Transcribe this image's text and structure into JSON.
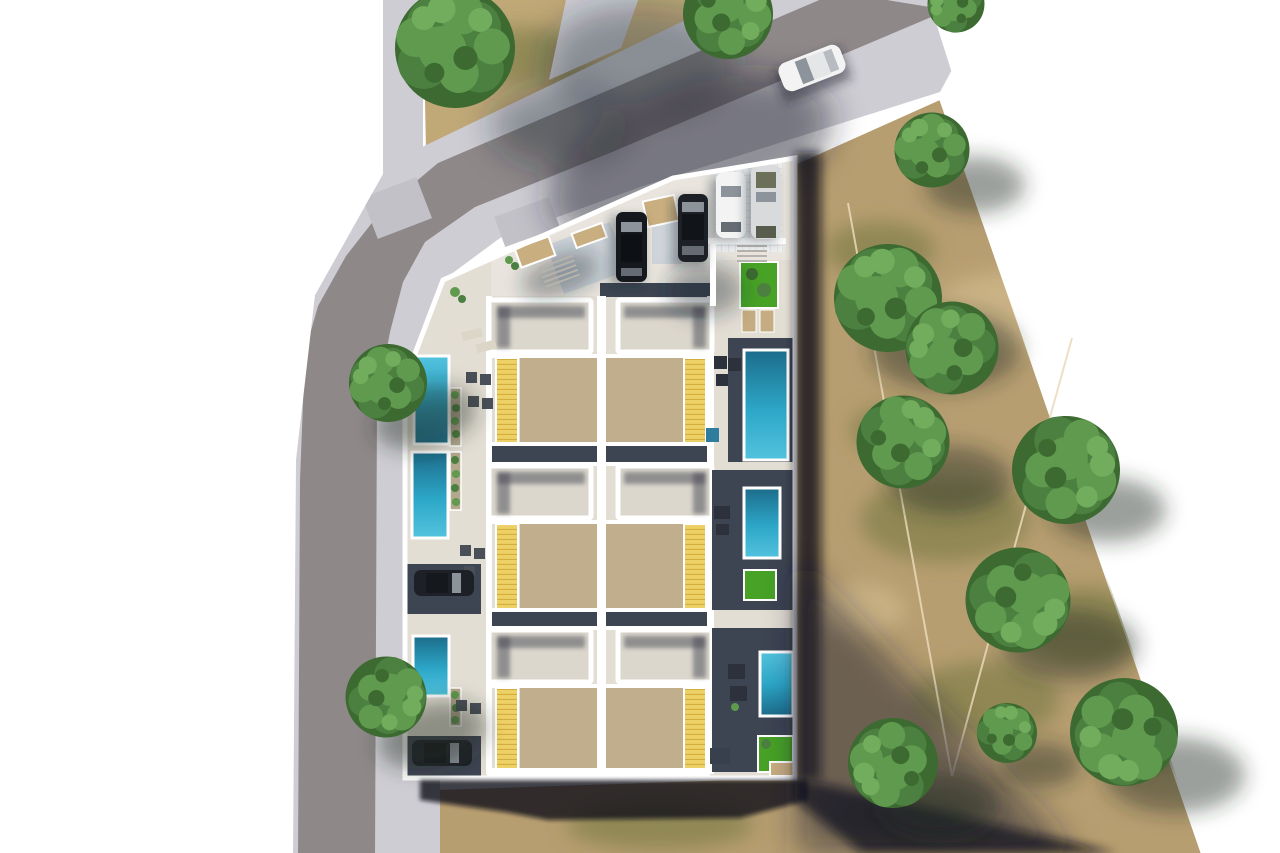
{
  "scene": {
    "type": "aerial-architectural-render",
    "description": "Top-down 3D rendering of a residential complex of six attached villas with flat roofs, sand courtyards, yellow louvered pergolas, private pools and a parking court; bordered by a diagonal street at top, a vertical street at left, and a dry field with trees at right",
    "units_total": 6,
    "rows": 3,
    "units_per_row": 2
  },
  "complex": {
    "pools": {
      "count": 6,
      "left_column": 3,
      "right_column": 3
    },
    "lawn_patches": 3,
    "louver_pergolas": 6,
    "roof_slabs": 6,
    "plaza_parked_cars": [
      "dark",
      "dark",
      "white",
      "silver"
    ],
    "driveway_cars": 2,
    "street_cars": 1,
    "planter_boxes": 3,
    "stair_flights": 2
  },
  "environment": {
    "roads": [
      "diagonal street top",
      "vertical street left"
    ],
    "sidewalks": true,
    "top_trees": 3,
    "street_trees": 2,
    "field_trees": 9,
    "survey_marker": "thin V-shaped boundary line in field"
  },
  "colors": {
    "white": "#ffffff",
    "field": "#b79e71",
    "grass": "#c0a877",
    "mottleGreen": "rgba(106,112,58,0.5)",
    "mottleTan": "rgba(216,194,150,0.55)",
    "pave": "#cecdd3",
    "road": "#8e8889",
    "pad": "#c2c1c8",
    "vline": "#ead9b8",
    "plaza": "#e9e5de",
    "patio": "#e3ded4",
    "deck": "#3d4452",
    "court": "#c0ae8d",
    "roof": "#dcd7cd",
    "roofShade": "rgba(68,70,82,0.5)",
    "wall": "#ffffff",
    "louver": "#eed166",
    "louverLine": "#d2ae3f",
    "poolBright": "#53c3de",
    "poolMid": "#2da7c8",
    "poolDeep": "#1c6c8a",
    "lawn": "#47a226",
    "planter": "#c9ae80",
    "planterDark": "#b3a78c",
    "treeA": "#3c6a31",
    "treeB": "#4c8040",
    "treeC": "#5f9a4e",
    "treeD": "#71ad5c",
    "chair": "#4a5058",
    "furn": "#2c313b",
    "loungerL": "#dcd6c8",
    "loungerT": "#c5ac82",
    "carDark": "#15181d",
    "carDark2": "#1d2127",
    "carWhite": "#f3f3f3",
    "carSilver": "#d9dadc",
    "glass": "#8d939b",
    "glassD": "#666c74",
    "glassOlive": "#6d7058",
    "tile2": "#ced4d9",
    "shadowSoft": "rgba(32,36,50,0.38)",
    "shadowMid": "rgba(32,36,50,0.5)",
    "shadowTree": "rgba(38,42,32,0.45)",
    "shadowBuild": "rgba(16,19,28,0.8)",
    "stepLine": "#b5b3ac",
    "boxBlue": "#2e7d9e",
    "boxDark": "#39404d"
  }
}
